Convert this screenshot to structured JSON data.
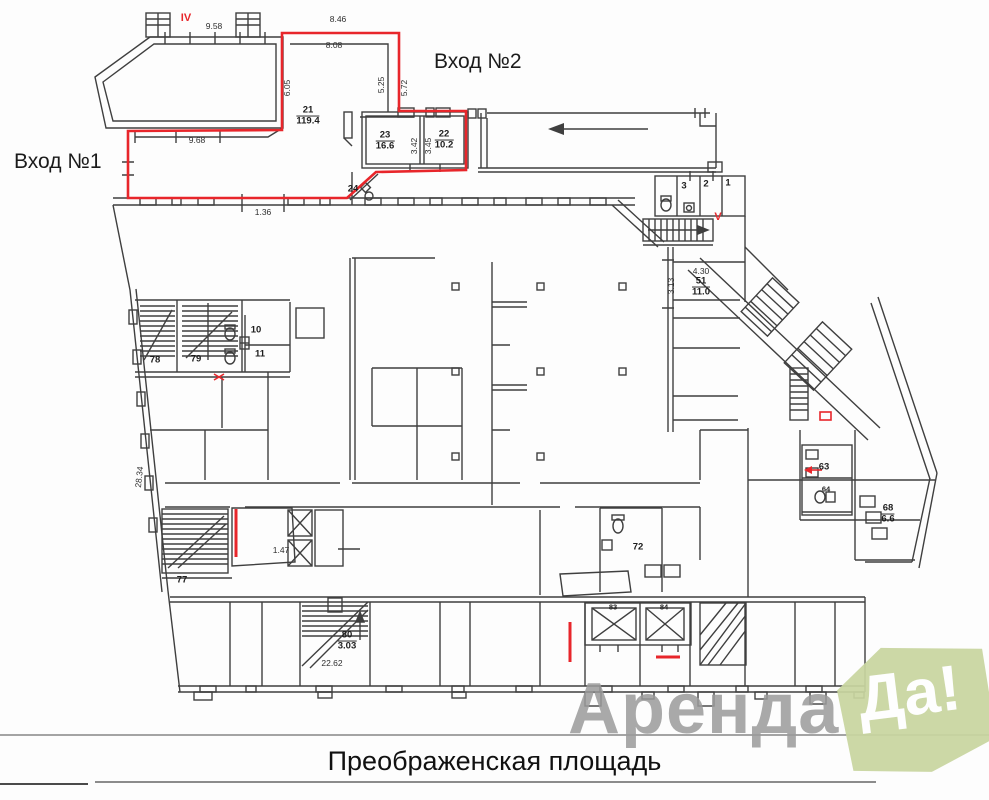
{
  "labels": {
    "entrance1": "Вход №1",
    "entrance2": "Вход №2"
  },
  "caption": "Преображенская площадь",
  "watermark": {
    "brand_gray": "Аренда",
    "brand_badge": "Да!",
    "gray_color": "#9b9b9b",
    "green_color": "#c9d6a0"
  },
  "colors": {
    "highlight_red": "#e8262b",
    "line_gray": "#3f3f3f"
  },
  "plan": {
    "dimensions": [
      {
        "t": "9.58",
        "x": 214,
        "y": 26,
        "r": 0
      },
      {
        "t": "8.46",
        "x": 338,
        "y": 19,
        "r": 0
      },
      {
        "t": "8.08",
        "x": 334,
        "y": 45,
        "r": 0
      },
      {
        "t": "6.05",
        "x": 287,
        "y": 88,
        "r": -90
      },
      {
        "t": "5.25",
        "x": 381,
        "y": 85,
        "r": -90
      },
      {
        "t": "5.72",
        "x": 404,
        "y": 88,
        "r": -90
      },
      {
        "t": "9.68",
        "x": 197,
        "y": 140,
        "r": 0
      },
      {
        "t": "1.36",
        "x": 263,
        "y": 212,
        "r": 0
      },
      {
        "t": "3.42",
        "x": 414,
        "y": 146,
        "r": -90
      },
      {
        "t": "3.45",
        "x": 428,
        "y": 146,
        "r": -90
      },
      {
        "t": "4.30",
        "x": 701,
        "y": 271,
        "r": 0
      },
      {
        "t": "3.13",
        "x": 671,
        "y": 286,
        "r": -90
      },
      {
        "t": "28.34",
        "x": 139,
        "y": 477,
        "r": -84
      },
      {
        "t": "1.47",
        "x": 281,
        "y": 550,
        "r": 0
      },
      {
        "t": "22.62",
        "x": 332,
        "y": 663,
        "r": 0
      }
    ],
    "rooms": [
      {
        "num": "21",
        "area": "119.4",
        "x": 308,
        "y": 116
      },
      {
        "num": "23",
        "area": "16.6",
        "x": 385,
        "y": 141
      },
      {
        "num": "22",
        "area": "10.2",
        "x": 444,
        "y": 140
      },
      {
        "num": "51",
        "area": "11.0",
        "x": 701,
        "y": 287
      },
      {
        "num": "80",
        "area": "3.03",
        "x": 347,
        "y": 641
      },
      {
        "num": "68",
        "area": "6.6",
        "x": 888,
        "y": 514
      },
      {
        "num": "24",
        "x": 353,
        "y": 189
      },
      {
        "num": "3",
        "x": 684,
        "y": 186
      },
      {
        "num": "2",
        "x": 706,
        "y": 184
      },
      {
        "num": "1",
        "x": 728,
        "y": 183
      },
      {
        "num": "10",
        "x": 256,
        "y": 330
      },
      {
        "num": "11",
        "x": 260,
        "y": 354
      },
      {
        "num": "78",
        "x": 155,
        "y": 360
      },
      {
        "num": "79",
        "x": 196,
        "y": 359
      },
      {
        "num": "77",
        "x": 182,
        "y": 580
      },
      {
        "num": "72",
        "x": 638,
        "y": 547
      },
      {
        "num": "63",
        "x": 824,
        "y": 467
      },
      {
        "num": "64",
        "x": 826,
        "y": 489,
        "small": true
      },
      {
        "num": "83",
        "x": 613,
        "y": 607,
        "small": true
      },
      {
        "num": "84",
        "x": 664,
        "y": 607,
        "small": true
      }
    ],
    "red_labels": [
      {
        "t": "IV",
        "x": 186,
        "y": 18
      },
      {
        "t": "V",
        "x": 718,
        "y": 217
      }
    ]
  }
}
